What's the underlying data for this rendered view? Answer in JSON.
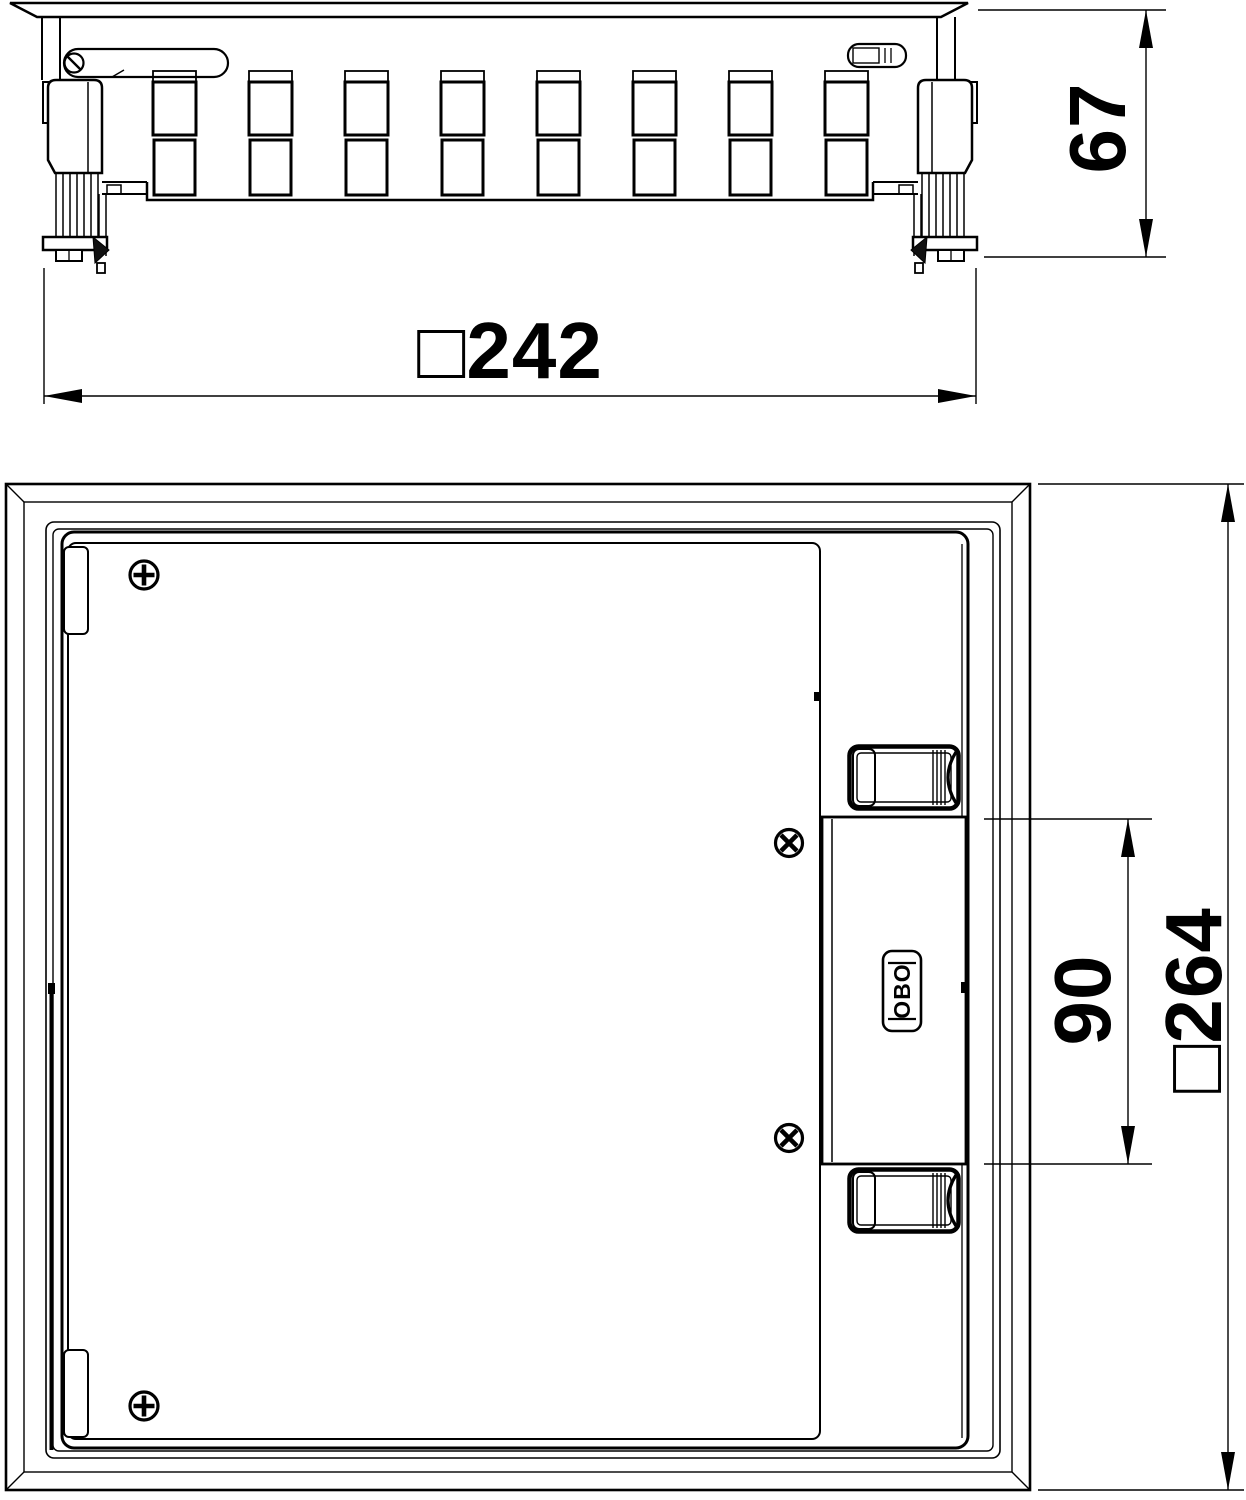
{
  "drawing": {
    "side_view": {
      "width_label": "□242",
      "height_label": "67"
    },
    "plan_view": {
      "outer_label": "□264",
      "insert_label": "90",
      "logo_text": "OBO"
    },
    "colors": {
      "line": "#000000",
      "background": "#ffffff"
    }
  }
}
